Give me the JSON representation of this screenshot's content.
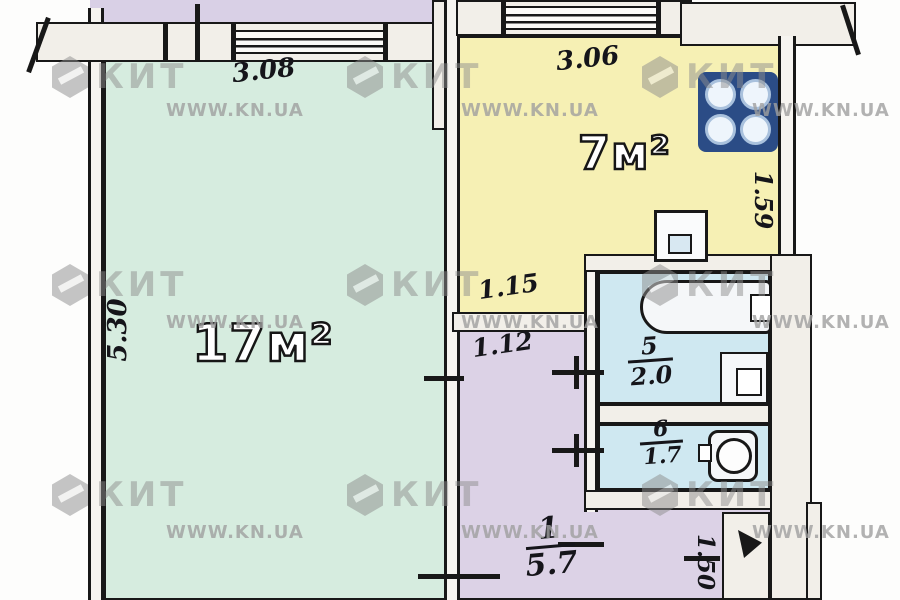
{
  "watermark": {
    "brand": "КИТ",
    "site": "WWW.KN.UA"
  },
  "rooms": {
    "living": {
      "area_label": "17м²",
      "dim_width": "3.08",
      "dim_height": "5.30"
    },
    "kitchen": {
      "area_label": "7м²",
      "dim_width": "3.06",
      "dim_inner": "1.15",
      "dim_side": "1.59"
    },
    "bathroom": {
      "number": "5",
      "area": "2.0"
    },
    "toilet": {
      "number": "6",
      "area": "1.7"
    },
    "hallway": {
      "number": "1",
      "area": "5.7",
      "dim_inner": "1.12",
      "dim_side": "1.50"
    }
  },
  "fixtures": {
    "stove": "stove-burners-icon",
    "sink": "kitchen-sink-icon",
    "bathtub": "bathtub-icon",
    "washbasin": "washbasin-icon",
    "toilet": "toilet-bowl-icon",
    "entrance": "door-swing-icon"
  },
  "colors": {
    "living": "#d6ecdf",
    "kitchen": "#f6f0b4",
    "hallway": "#dcd2e6",
    "wet_rooms": "#cfe8f1",
    "neighbor": "#d9d0e6",
    "stove": "#2b4c86",
    "walls": "#181818",
    "watermark": "#8f8f8f"
  }
}
